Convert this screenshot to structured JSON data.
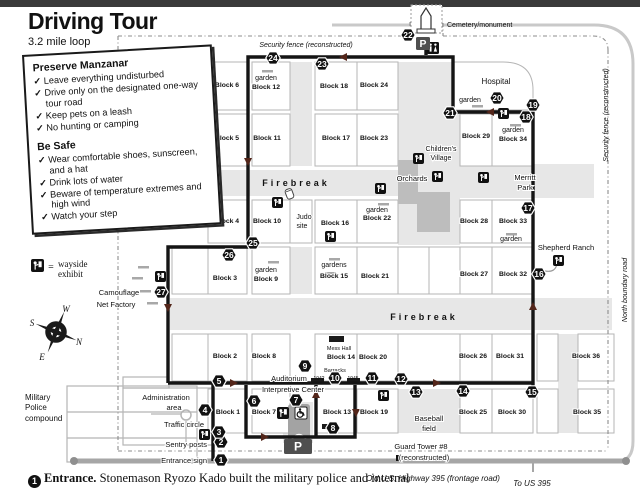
{
  "page": {
    "title": "Driving Tour",
    "subtitle": "3.2 mile loop",
    "footer_stop_number": "1",
    "footer_text_bold": "Entrance.",
    "footer_text": "Stonemason Ryozo Kado built the military police and internal"
  },
  "info_box": {
    "preserve_heading": "Preserve Manzanar",
    "preserve_items": [
      "Leave everything undisturbed",
      "Drive only on the designated one-way tour road",
      "Keep pets on a leash",
      "No hunting or camping"
    ],
    "safe_heading": "Be Safe",
    "safe_items": [
      "Wear comfortable shoes, sunscreen, and a hat",
      "Drink lots of water",
      "Beware of temperature extremes and high wind",
      "Watch your step"
    ]
  },
  "legend": {
    "equals": "=",
    "line1": "wayside",
    "line2": "exhibit"
  },
  "compass": {
    "n": "N",
    "s": "S",
    "e": "E",
    "w": "W"
  },
  "map": {
    "colors": {
      "shade": "#e7e7e7",
      "orchard": "#bdbdbd",
      "cell_stroke": "#b5b5b5",
      "tour_road": "#141414",
      "arrow": "#53261a",
      "fence": "#8c8c8c",
      "highway": "#a6a6a6",
      "boundary": "#c9c9c9",
      "bar": "#a8a8a8",
      "building": "#a3a3a3",
      "parking": "#4f4f4f"
    },
    "areas": [
      [
        398,
        62,
        62,
        183
      ],
      [
        170,
        170,
        228,
        26
      ],
      [
        460,
        164,
        134,
        34
      ],
      [
        170,
        298,
        442,
        32
      ],
      [
        290,
        62,
        22,
        104
      ],
      [
        290,
        247,
        22,
        47
      ],
      [
        558,
        334,
        20,
        99
      ],
      [
        398,
        389,
        62,
        44
      ],
      [
        283,
        402,
        30,
        41
      ]
    ],
    "orchards": [
      [
        398,
        160,
        20,
        44
      ],
      [
        417,
        192,
        33,
        40
      ]
    ],
    "empty_cells": [
      [
        172,
        247,
        36,
        47
      ],
      [
        172,
        334,
        36,
        47
      ],
      [
        290,
        200,
        22,
        43
      ],
      [
        398,
        247,
        31,
        47
      ],
      [
        429,
        247,
        31,
        47
      ],
      [
        398,
        334,
        62,
        47
      ],
      [
        537,
        334,
        21,
        47
      ],
      [
        537,
        389,
        21,
        44
      ]
    ],
    "blocks": [
      {
        "label": "Block 6",
        "lx": 227,
        "ly": 87,
        "cell": [
          208,
          62,
          39,
          48
        ]
      },
      {
        "label": "Block 12",
        "lx": 266,
        "ly": 89,
        "cell": [
          252,
          62,
          38,
          48
        ]
      },
      {
        "label": "Block 18",
        "lx": 334,
        "ly": 88,
        "cell": [
          315,
          62,
          42,
          48
        ]
      },
      {
        "label": "Block 24",
        "lx": 374,
        "ly": 87,
        "cell": [
          357,
          62,
          41,
          48
        ]
      },
      {
        "label": "Block 5",
        "lx": 227,
        "ly": 140,
        "cell": [
          208,
          114,
          39,
          52
        ]
      },
      {
        "label": "Block 11",
        "lx": 267,
        "ly": 140,
        "cell": [
          252,
          114,
          38,
          52
        ]
      },
      {
        "label": "Block 17",
        "lx": 336,
        "ly": 140,
        "cell": [
          315,
          114,
          42,
          52
        ]
      },
      {
        "label": "Block 23",
        "lx": 374,
        "ly": 140,
        "cell": [
          357,
          114,
          41,
          52
        ]
      },
      {
        "label": "Block 29",
        "lx": 476,
        "ly": 138,
        "cell": [
          460,
          114,
          32,
          52
        ]
      },
      {
        "label": "Block 34",
        "lx": 513,
        "ly": 141,
        "cell": [
          492,
          114,
          41,
          52
        ]
      },
      {
        "label": "Block 4",
        "lx": 227,
        "ly": 223,
        "cell": [
          208,
          200,
          39,
          43
        ]
      },
      {
        "label": "Block 10",
        "lx": 267,
        "ly": 223,
        "cell": [
          252,
          200,
          38,
          43
        ]
      },
      {
        "label": "Block 16",
        "lx": 335,
        "ly": 225,
        "cell": [
          315,
          200,
          42,
          43
        ]
      },
      {
        "label": "Block 22",
        "lx": 377,
        "ly": 220,
        "cell": [
          357,
          200,
          41,
          43
        ]
      },
      {
        "label": "Block 28",
        "lx": 474,
        "ly": 223,
        "cell": [
          460,
          200,
          32,
          43
        ]
      },
      {
        "label": "Block 33",
        "lx": 513,
        "ly": 223,
        "cell": [
          492,
          200,
          41,
          43
        ]
      },
      {
        "label": "Block 3",
        "lx": 225,
        "ly": 280,
        "cell": [
          208,
          247,
          39,
          47
        ]
      },
      {
        "label": "Block 9",
        "lx": 266,
        "ly": 281,
        "cell": [
          252,
          247,
          38,
          47
        ]
      },
      {
        "label": "Block 15",
        "lx": 334,
        "ly": 278,
        "cell": [
          315,
          247,
          42,
          47
        ]
      },
      {
        "label": "Block 21",
        "lx": 375,
        "ly": 278,
        "cell": [
          357,
          247,
          41,
          47
        ]
      },
      {
        "label": "Block 27",
        "lx": 474,
        "ly": 276,
        "cell": [
          460,
          247,
          32,
          47
        ]
      },
      {
        "label": "Block 32",
        "lx": 513,
        "ly": 276,
        "cell": [
          492,
          247,
          41,
          47
        ]
      },
      {
        "label": "Block 2",
        "lx": 225,
        "ly": 358,
        "cell": [
          208,
          334,
          39,
          47
        ]
      },
      {
        "label": "Block 8",
        "lx": 264,
        "ly": 358,
        "cell": [
          252,
          334,
          38,
          47
        ]
      },
      {
        "label": "Block 14",
        "lx": 341,
        "ly": 359,
        "cell": [
          315,
          334,
          42,
          47
        ]
      },
      {
        "label": "Block 20",
        "lx": 373,
        "ly": 359,
        "cell": [
          357,
          334,
          41,
          47
        ]
      },
      {
        "label": "Block 26",
        "lx": 473,
        "ly": 358,
        "cell": [
          460,
          334,
          32,
          47
        ]
      },
      {
        "label": "Block 31",
        "lx": 510,
        "ly": 358,
        "cell": [
          492,
          334,
          41,
          47
        ]
      },
      {
        "label": "Block 36",
        "lx": 586,
        "ly": 358,
        "cell": [
          578,
          334,
          36,
          47
        ]
      },
      {
        "label": "Block 1",
        "lx": 228,
        "ly": 414,
        "cell": [
          208,
          389,
          39,
          44
        ]
      },
      {
        "label": "Block 7",
        "lx": 264,
        "ly": 414,
        "cell": [
          252,
          389,
          38,
          44
        ]
      },
      {
        "label": "Block 13",
        "lx": 337,
        "ly": 414,
        "cell": [
          315,
          389,
          42,
          44
        ]
      },
      {
        "label": "Block 19",
        "lx": 374,
        "ly": 414,
        "cell": [
          357,
          389,
          41,
          44
        ]
      },
      {
        "label": "Block 25",
        "lx": 473,
        "ly": 414,
        "cell": [
          460,
          389,
          32,
          44
        ]
      },
      {
        "label": "Block 30",
        "lx": 512,
        "ly": 414,
        "cell": [
          492,
          389,
          41,
          44
        ]
      },
      {
        "label": "Block 35",
        "lx": 587,
        "ly": 414,
        "cell": [
          578,
          389,
          36,
          44
        ]
      }
    ],
    "labels": [
      {
        "t": "Security fence (reconstructed)",
        "x": 306,
        "y": 47,
        "s": 7,
        "i": 1,
        "h": 1
      },
      {
        "t": "Cemetery/monument",
        "x": 447,
        "y": 27,
        "s": 7,
        "a": "start"
      },
      {
        "t": "Hospital",
        "x": 496,
        "y": 84,
        "s": 8
      },
      {
        "t": "garden",
        "x": 470,
        "y": 102,
        "s": 7
      },
      {
        "t": "garden",
        "x": 266,
        "y": 80,
        "s": 7
      },
      {
        "t": "garden",
        "x": 513,
        "y": 132,
        "s": 7
      },
      {
        "t": "garden",
        "x": 377,
        "y": 212,
        "s": 7,
        "h": 1
      },
      {
        "t": "garden",
        "x": 266,
        "y": 272,
        "s": 7
      },
      {
        "t": "gardens",
        "x": 334,
        "y": 267,
        "s": 7
      },
      {
        "t": "garden",
        "x": 511,
        "y": 241,
        "s": 7
      },
      {
        "t": "Children's",
        "x": 441,
        "y": 151,
        "s": 7,
        "h": 1
      },
      {
        "t": "Village",
        "x": 441,
        "y": 160,
        "s": 7,
        "h": 1
      },
      {
        "t": "Orchards",
        "x": 412,
        "y": 181,
        "s": 7.5,
        "h": 1
      },
      {
        "t": "Merritt",
        "x": 525,
        "y": 180,
        "s": 7.5,
        "h": 1
      },
      {
        "t": "Park",
        "x": 525,
        "y": 190,
        "s": 7.5,
        "h": 1
      },
      {
        "t": "Shepherd Ranch",
        "x": 566,
        "y": 250,
        "s": 7.5
      },
      {
        "t": "Judo",
        "x": 304,
        "y": 219,
        "s": 7,
        "h": 1
      },
      {
        "t": "site",
        "x": 302,
        "y": 228,
        "s": 7,
        "h": 1
      },
      {
        "t": "Firebreak",
        "x": 296,
        "y": 186,
        "s": 9,
        "b": 1,
        "ls": 3
      },
      {
        "t": "Firebreak",
        "x": 424,
        "y": 320,
        "s": 9,
        "b": 1,
        "ls": 3
      },
      {
        "t": "Mess Hall",
        "x": 339,
        "y": 350,
        "s": 5.5
      },
      {
        "t": "Barracks",
        "x": 335,
        "y": 372,
        "s": 5.5
      },
      {
        "t": "1942",
        "x": 319,
        "y": 380,
        "s": 5
      },
      {
        "t": "1945",
        "x": 353,
        "y": 380,
        "s": 5
      },
      {
        "t": "Auditorium",
        "x": 289,
        "y": 381,
        "s": 7.5,
        "h": 1
      },
      {
        "t": "Interpretive Center",
        "x": 293,
        "y": 392,
        "s": 7.5,
        "h": 1
      },
      {
        "t": "Baseball",
        "x": 429,
        "y": 421,
        "s": 7.5,
        "h": 1
      },
      {
        "t": "field",
        "x": 429,
        "y": 431,
        "s": 7.5,
        "h": 1
      },
      {
        "t": "Administration",
        "x": 166,
        "y": 400,
        "s": 7.5,
        "h": 1
      },
      {
        "t": "area",
        "x": 174,
        "y": 410,
        "s": 7.5,
        "h": 1
      },
      {
        "t": "Traffic circle",
        "x": 184,
        "y": 427,
        "s": 7.5,
        "h": 1
      },
      {
        "t": "Sentry posts",
        "x": 207,
        "y": 447,
        "s": 7.5,
        "a": "end",
        "h": 1
      },
      {
        "t": "Entrance sign",
        "x": 207,
        "y": 463,
        "s": 7.5,
        "a": "end",
        "h": 1
      },
      {
        "t": "Military",
        "x": 25,
        "y": 400,
        "s": 8,
        "a": "start"
      },
      {
        "t": "Police",
        "x": 25,
        "y": 410,
        "s": 8,
        "a": "start"
      },
      {
        "t": "compound",
        "x": 25,
        "y": 421,
        "s": 8,
        "a": "start"
      },
      {
        "t": "Camouflage",
        "x": 119,
        "y": 295,
        "s": 7.5,
        "h": 1
      },
      {
        "t": "Net Factory",
        "x": 116,
        "y": 307,
        "s": 7.5,
        "h": 1
      },
      {
        "t": "Guard Tower #8",
        "x": 421,
        "y": 449,
        "s": 7.5,
        "h": 1
      },
      {
        "t": "(reconstructed)",
        "x": 424,
        "y": 460,
        "s": 7.5,
        "h": 1
      },
      {
        "t": "Old U.S. Highway 395 (frontage road)",
        "x": 433,
        "y": 481,
        "s": 8,
        "i": 1
      },
      {
        "t": "To US 395",
        "x": 532,
        "y": 486,
        "s": 8,
        "i": 1
      },
      {
        "t": "Security fence (reconstructed)",
        "x": 608,
        "y": 115,
        "s": 7,
        "i": 1,
        "r": -90
      },
      {
        "t": "North boundary road",
        "x": 627,
        "y": 290,
        "s": 7,
        "i": 1,
        "r": -90
      }
    ],
    "garden_bars": [
      [
        262,
        70
      ],
      [
        510,
        124
      ],
      [
        378,
        203
      ],
      [
        268,
        261
      ],
      [
        329,
        258
      ],
      [
        325,
        272
      ],
      [
        506,
        233
      ],
      [
        472,
        105
      ],
      [
        138,
        266
      ],
      [
        132,
        277
      ],
      [
        140,
        290
      ],
      [
        147,
        302
      ]
    ],
    "black_bars": [
      [
        329,
        336,
        15,
        6
      ],
      [
        311,
        378,
        13,
        5
      ],
      [
        347,
        378,
        13,
        5
      ],
      [
        322,
        424,
        6,
        5
      ]
    ],
    "stops": [
      [
        1,
        221,
        460
      ],
      [
        2,
        221,
        442
      ],
      [
        3,
        219,
        432
      ],
      [
        4,
        205,
        410
      ],
      [
        5,
        219,
        381
      ],
      [
        6,
        254,
        401
      ],
      [
        7,
        296,
        400
      ],
      [
        8,
        333,
        428
      ],
      [
        9,
        305,
        366
      ],
      [
        10,
        335,
        378
      ],
      [
        11,
        372,
        378
      ],
      [
        12,
        401,
        379
      ],
      [
        13,
        416,
        392
      ],
      [
        14,
        463,
        391
      ],
      [
        15,
        532,
        392
      ],
      [
        16,
        539,
        274
      ],
      [
        17,
        528,
        208
      ],
      [
        18,
        526,
        117
      ],
      [
        19,
        533,
        105
      ],
      [
        20,
        497,
        98
      ],
      [
        21,
        450,
        113
      ],
      [
        22,
        408,
        35
      ],
      [
        23,
        322,
        64
      ],
      [
        24,
        273,
        58
      ],
      [
        25,
        253,
        243
      ],
      [
        26,
        229,
        255
      ],
      [
        27,
        161,
        292
      ]
    ],
    "icons": [
      {
        "type": "wayside",
        "x": 155,
        "y": 271,
        "s": 11
      },
      {
        "type": "wayside",
        "x": 272,
        "y": 197,
        "s": 11
      },
      {
        "type": "wayside",
        "x": 325,
        "y": 231,
        "s": 11
      },
      {
        "type": "wayside",
        "x": 375,
        "y": 183,
        "s": 11
      },
      {
        "type": "wayside",
        "x": 413,
        "y": 153,
        "s": 11
      },
      {
        "type": "wayside",
        "x": 432,
        "y": 171,
        "s": 11
      },
      {
        "type": "wayside",
        "x": 478,
        "y": 172,
        "s": 11
      },
      {
        "type": "wayside",
        "x": 498,
        "y": 108,
        "s": 11
      },
      {
        "type": "wayside",
        "x": 424,
        "y": 22,
        "s": 11
      },
      {
        "type": "wayside",
        "x": 199,
        "y": 429,
        "s": 11
      },
      {
        "type": "wayside",
        "x": 378,
        "y": 390,
        "s": 11
      },
      {
        "type": "wayside",
        "x": 553,
        "y": 255,
        "s": 11
      },
      {
        "type": "wayside",
        "x": 277,
        "y": 407,
        "s": 12
      },
      {
        "type": "restroom",
        "x": 427,
        "y": 42,
        "s": 12
      },
      {
        "type": "accessible",
        "x": 295,
        "y": 407,
        "s": 12
      },
      {
        "type": "parking",
        "x": 416,
        "y": 37,
        "w": 14,
        "h": 13
      },
      {
        "type": "parking",
        "x": 284,
        "y": 439,
        "w": 28,
        "h": 15
      },
      {
        "type": "monument",
        "x": 426,
        "y": 8
      },
      {
        "type": "jar",
        "x": 286,
        "y": 189
      },
      {
        "type": "tower",
        "x": 396,
        "y": 455
      }
    ],
    "tour_roads": [
      "M 213,461 V 383",
      "M 168,383 H 533",
      "M 533,386 V 112 H 453 V 57 H 248 V 247 H 168 V 383",
      "M 246,385 V 437 H 355 V 385",
      "M 316,385 V 437",
      "M 426,55 V 43"
    ],
    "fence_paths": [
      "M 118,36 H 410",
      "M 410,36 V 21 H 443 V 36",
      "M 443,36 H 593 Q 608,36 608,50",
      "M 608,50 V 450",
      "M 118,36 V 451",
      "M 118,451 H 608"
    ],
    "boundary_road": "M 332,25 H 594 Q 633,25 633,64 V 441 Q 633,461 618,461",
    "highway": "M 74,461 H 626",
    "hwy_tick": "M 533,461 V 472",
    "hospital_path": "M 453,110 V 62 H 503 Q 533,62 533,90 V 110 Z",
    "leader_16": "M 545,271 Q 556,273 557,263",
    "arrows": [
      {
        "x": 248,
        "y": 162,
        "d": "s"
      },
      {
        "x": 168,
        "y": 308,
        "d": "s"
      },
      {
        "x": 234,
        "y": 383,
        "d": "e"
      },
      {
        "x": 437,
        "y": 383,
        "d": "e"
      },
      {
        "x": 533,
        "y": 306,
        "d": "n"
      },
      {
        "x": 490,
        "y": 112,
        "d": "w"
      },
      {
        "x": 343,
        "y": 57,
        "d": "w"
      },
      {
        "x": 316,
        "y": 394,
        "d": "n"
      },
      {
        "x": 265,
        "y": 437,
        "d": "e"
      },
      {
        "x": 356,
        "y": 413,
        "d": "s"
      }
    ],
    "admin": {
      "rects": [
        [
          123,
          388,
          90,
          57
        ],
        [
          123,
          377,
          46,
          11
        ]
      ],
      "lines": [
        "M 186,421 V 445",
        "M 151,414 H 181"
      ],
      "circle": [
        186,
        415,
        5
      ]
    },
    "mp_compound": {
      "rect": [
        67,
        386,
        130,
        76
      ],
      "lines": [
        "M 67,412 H 197",
        "M 67,438 H 197"
      ]
    },
    "bldg": {
      "rect": [
        288,
        404,
        22,
        38
      ],
      "arch": "M 291,441 Q 299,428 307,441"
    }
  }
}
